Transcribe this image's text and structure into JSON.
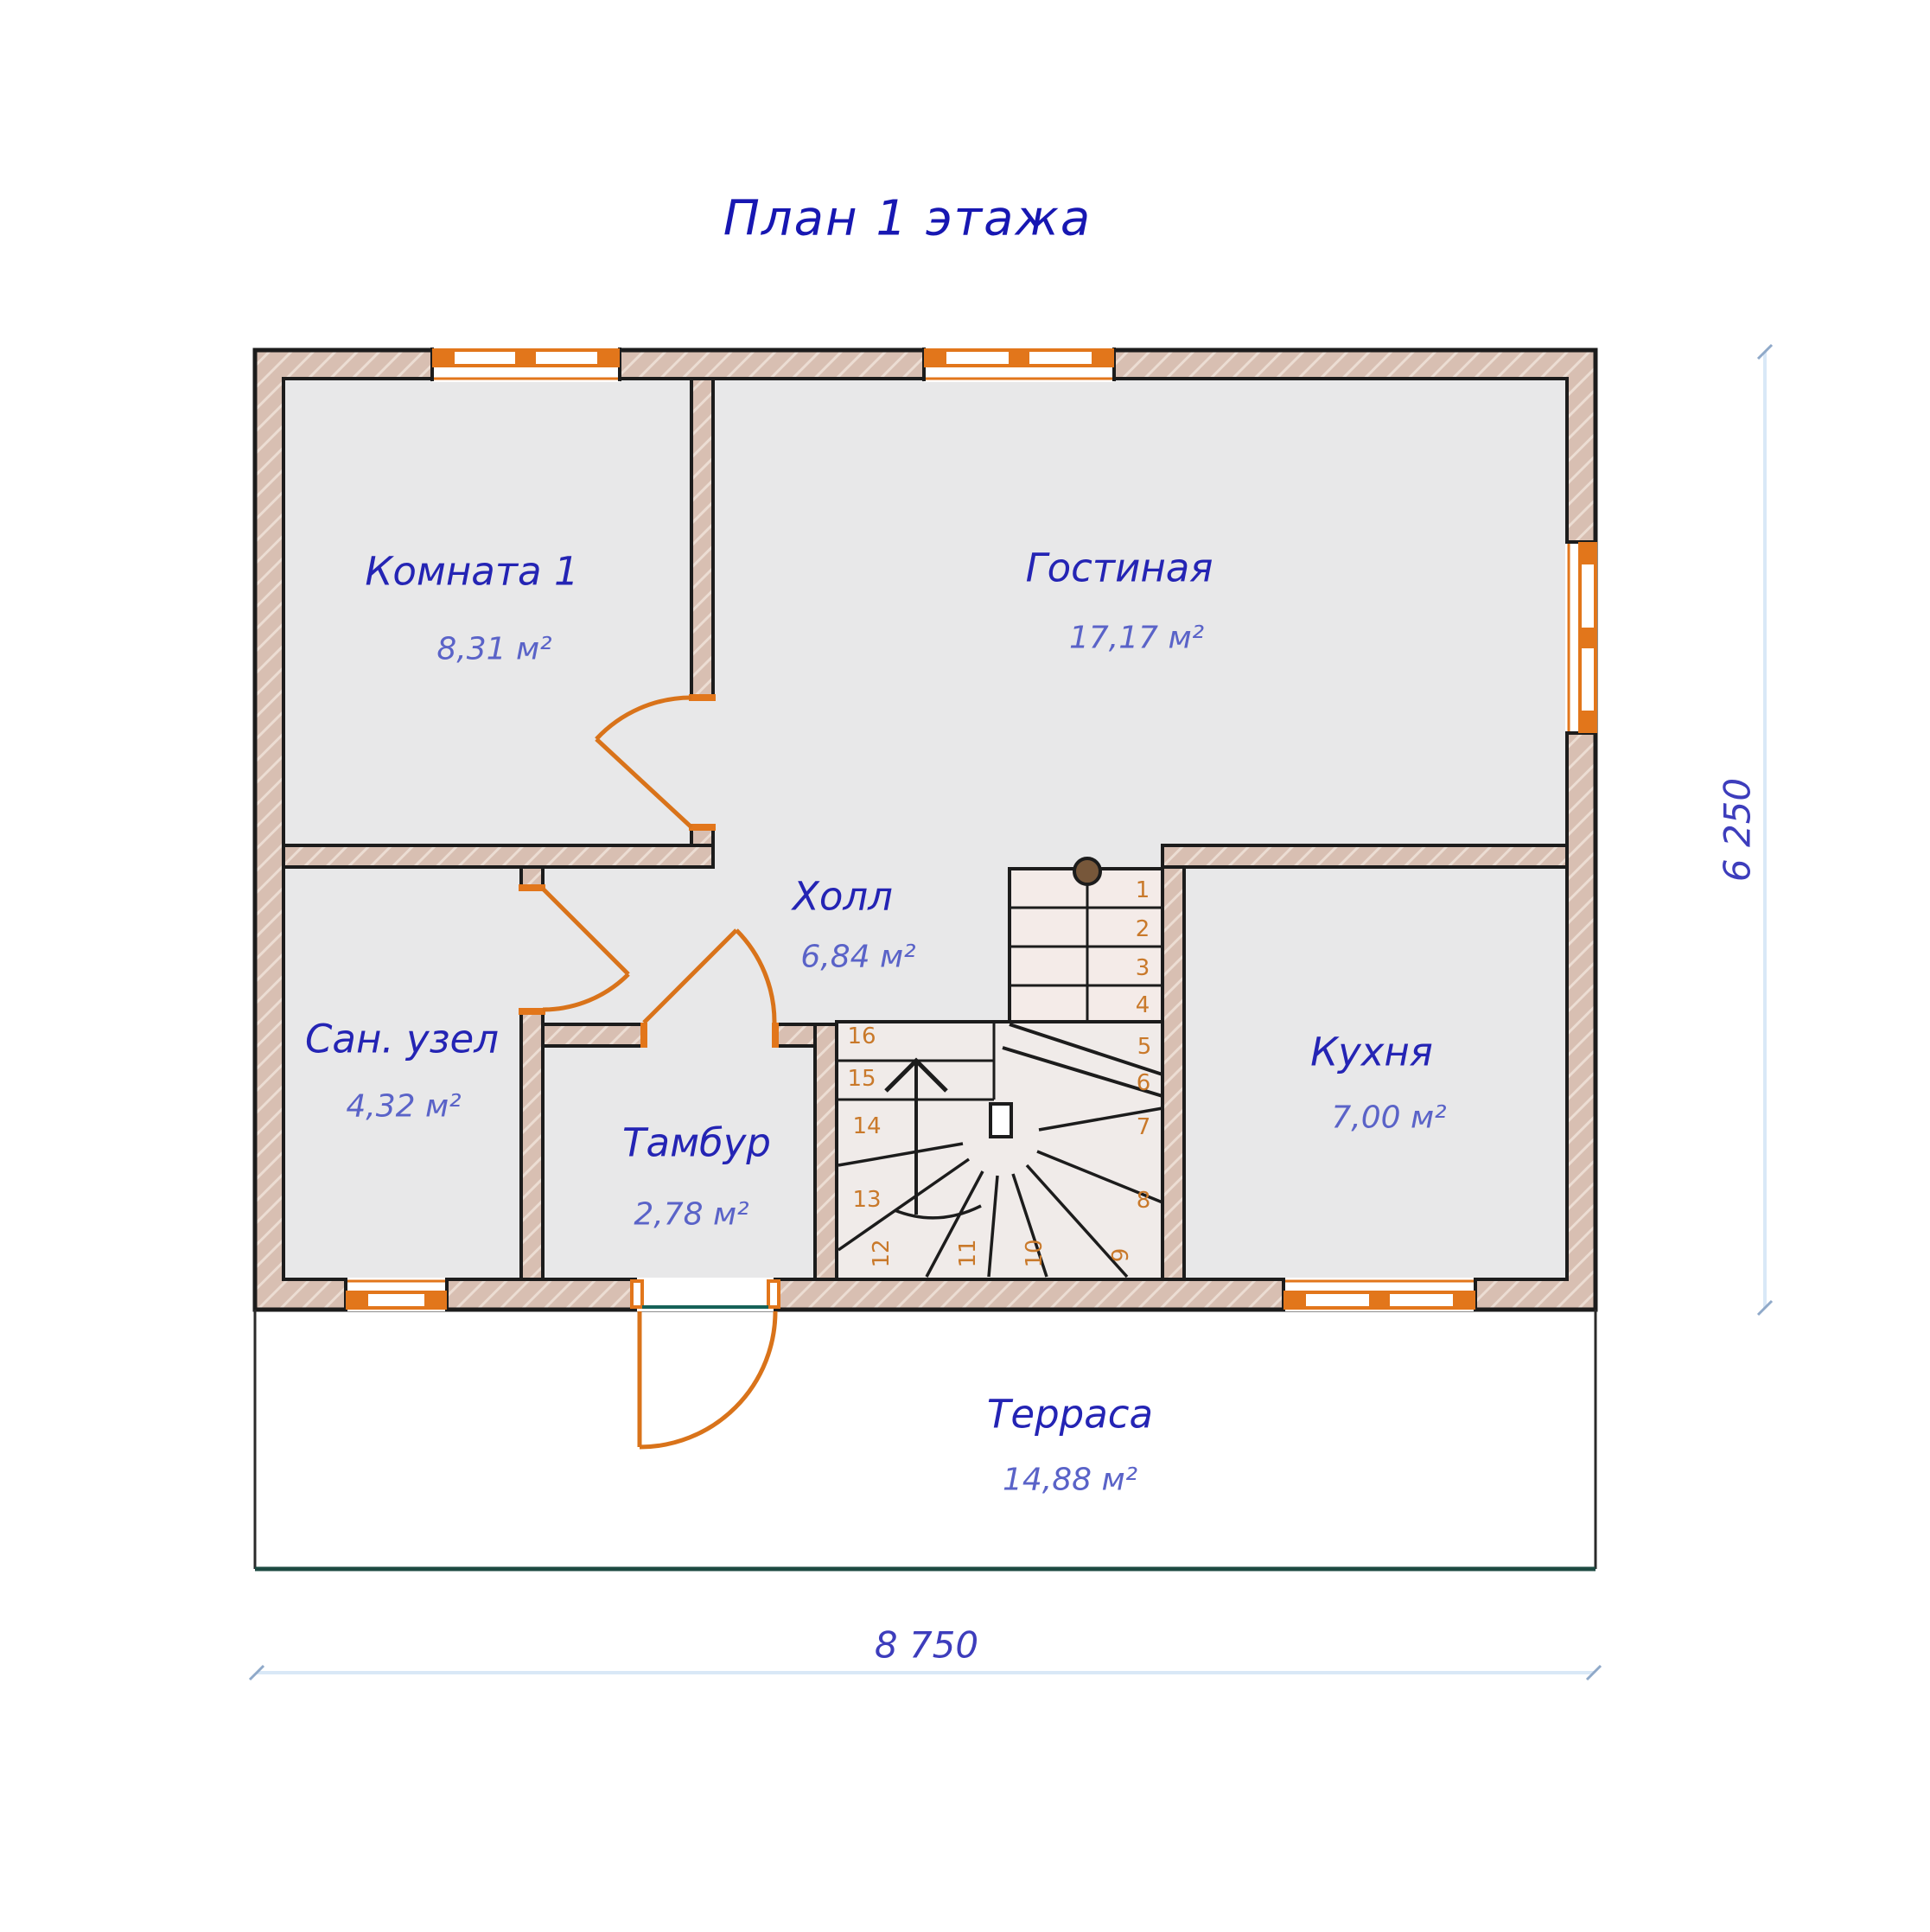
{
  "title": "План 1 этажа",
  "rooms": [
    {
      "id": "komnata1",
      "name": "Комната 1",
      "area": "8,31 м²"
    },
    {
      "id": "gostinaya",
      "name": "Гостиная",
      "area": "17,17 м²"
    },
    {
      "id": "hall",
      "name": "Холл",
      "area": "6,84 м²"
    },
    {
      "id": "san_uzel",
      "name": "Сан. узел",
      "area": "4,32 м²"
    },
    {
      "id": "tambur",
      "name": "Тамбур",
      "area": "2,78 м²"
    },
    {
      "id": "kuhnya",
      "name": "Кухня",
      "area": "7,00 м²"
    },
    {
      "id": "terrasa",
      "name": "Терраса",
      "area": "14,88 м²"
    }
  ],
  "dimensions": {
    "width": "8 750",
    "height": "6 250"
  },
  "stairs": {
    "steps": [
      "1",
      "2",
      "3",
      "4",
      "5",
      "6",
      "7",
      "8",
      "9",
      "10",
      "11",
      "12",
      "13",
      "14",
      "15",
      "16"
    ]
  },
  "colors": {
    "title_blue": "#1717b2",
    "room_label_blue": "#2424b4",
    "area_label_blue": "#5a63c8",
    "step_number_orange": "#c9792a",
    "window_door_orange": "#e2761b",
    "wall_fill_tan": "#d8bfb2",
    "wall_hatch": "#ecddd3",
    "floor_gray": "#e8e8e9",
    "stair_tread_pink": "#f4ebe8",
    "threshold_teal": "#166258",
    "terrace_edge_dark": "#1d4a42",
    "dimension_line_blue": "#d9e8f7",
    "dimension_text_blue": "#3d3dbc",
    "newel_brown": "#77573a",
    "wall_line_black": "#1c1c1c"
  }
}
